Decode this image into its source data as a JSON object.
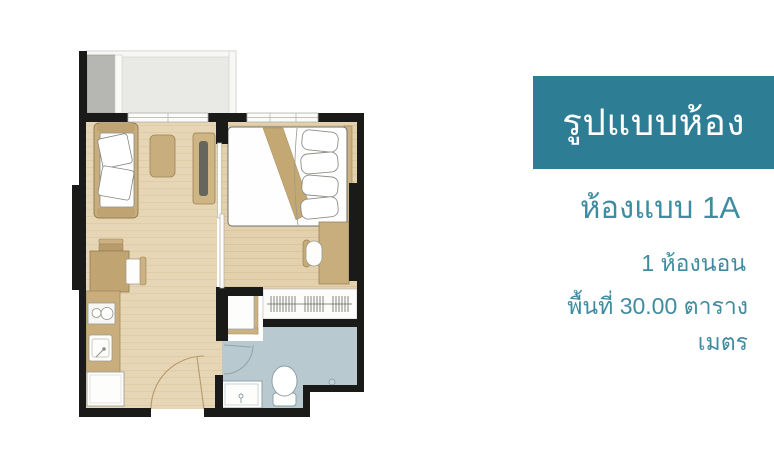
{
  "panel": {
    "banner": {
      "title": "รูปแบบห้อง",
      "bg_color": "#2d7e95",
      "text_color": "#ffffff"
    },
    "room_type": "ห้องแบบ 1A",
    "bedrooms": "1 ห้องนอน",
    "area": "พื้นที่ 30.00 ตารางเมตร",
    "accent_color": "#3f8ca0"
  },
  "floor_plan": {
    "type": "one-bedroom-unit-floor-plan",
    "rooms": [
      "balcony",
      "living-area",
      "bedroom",
      "kitchen",
      "bathroom",
      "wardrobe",
      "entrance-hall"
    ],
    "furniture": [
      "sofa",
      "throw-pillows",
      "coffee-table",
      "tv-console",
      "dining-table",
      "dining-chairs",
      "kitchen-counter",
      "stove",
      "kitchen-sink",
      "refrigerator",
      "double-bed",
      "bed-pillows",
      "blanket-runner",
      "desk",
      "desk-chair",
      "clothes-rail-hangers",
      "cabinet",
      "toilet",
      "bathroom-vanity",
      "floor-drain",
      "air-con-pad"
    ],
    "colors": {
      "wall": "#1a1a18",
      "wood_floor": "#e7d5b4",
      "wood_floor_bedroom": "#e3d0ad",
      "furniture_tan": "#cbb083",
      "furniture_dark_tan": "#b89c6c",
      "balcony_floor": "#e9e9e6",
      "ac_pad": "#b6b6b3",
      "bathroom_floor": "#b8c9cf",
      "fixture_white": "#fdfdfc"
    }
  }
}
